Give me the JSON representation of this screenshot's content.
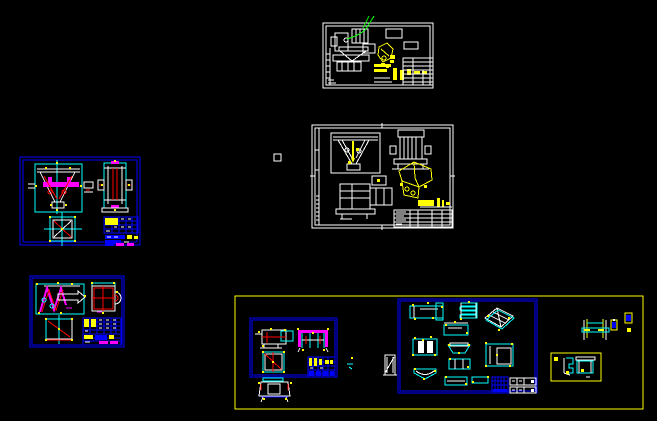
{
  "workspace": {
    "app": "CAD model space",
    "background": "#000000",
    "description": "Black CAD canvas showing five engineering drawing sheets of a mixer/hopper machine with detail part layouts"
  },
  "colors": {
    "black": "#000000",
    "white": "#ffffff",
    "yellow": "#ffff00",
    "cyan": "#00ffff",
    "blue": "#0000ff",
    "red": "#ff0000",
    "magenta": "#ff00ff",
    "green": "#00ff00"
  },
  "sheets": [
    {
      "id": "sheet-top-assembly",
      "border": "#ffffff",
      "note": "small assembly sheet, green leader line, yellow highlighted part and title bars"
    },
    {
      "id": "sheet-main-assembly",
      "border": "#ffffff",
      "note": "large assembly sheet with three white views, yellow isometric hopper and yellow title-block bars"
    },
    {
      "id": "sheet-left-fixture",
      "border": "#0000ff",
      "note": "blue-framed sheet: front/side/top views with magenta crossbar, red braces, cyan outlines, parts table"
    },
    {
      "id": "sheet-lower-left-detail",
      "border": "#0000ff",
      "note": "blue-framed sheet: magenta zig-zag weldment, red cross view, square view, parts table with magenta rows"
    },
    {
      "id": "panel-bottom-parts",
      "border": "#ffff00",
      "note": "yellow bounding region with two blue sub-sheets of part details, shaft detail, small part box and loose parts"
    }
  ],
  "markers": {
    "small_square": "white square outline on empty canvas area"
  }
}
